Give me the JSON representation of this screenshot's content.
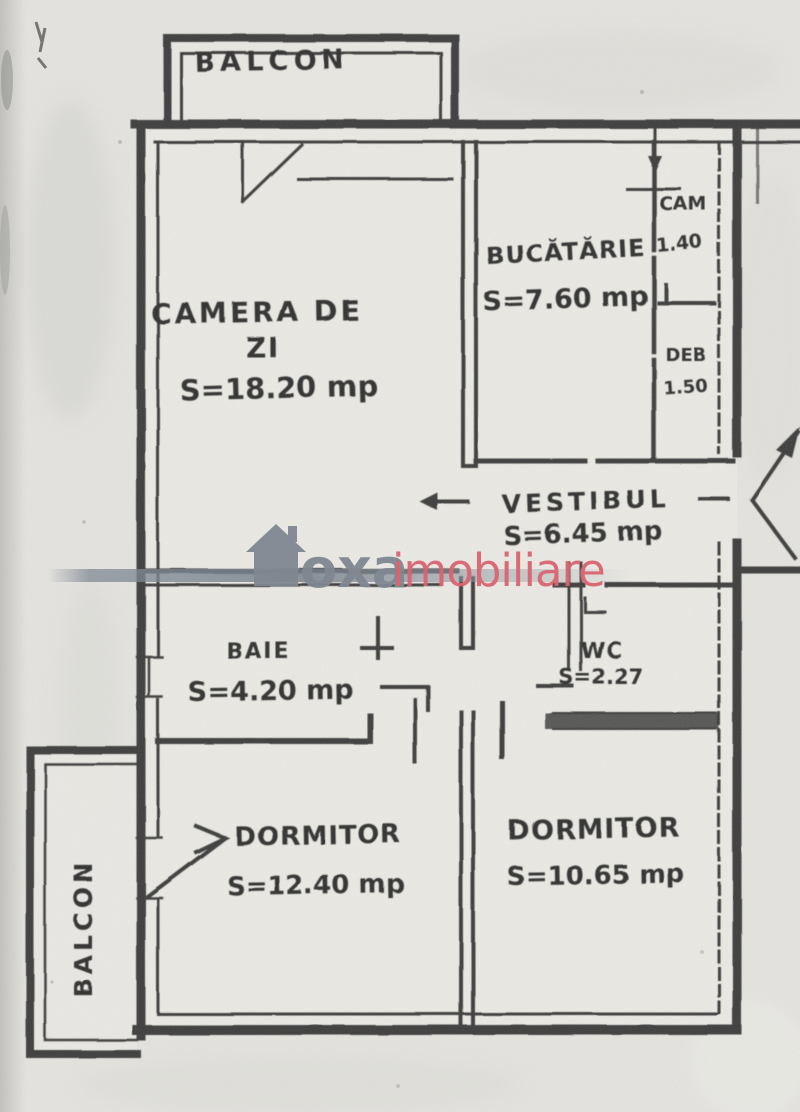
{
  "document": {
    "type": "scanned apartment floor plan",
    "language": "Romanian"
  },
  "plan": {
    "balconies": [
      {
        "label": "BALCON",
        "position": "top"
      },
      {
        "label": "BALCON",
        "position": "left"
      }
    ],
    "rooms": [
      {
        "name": "CAMERA DE",
        "name_line2": "ZI",
        "area": "S=18.20 mp"
      },
      {
        "name": "BUCĂTĂRIE",
        "area": "S=7.60 mp"
      },
      {
        "name": "CAM",
        "area": "1.40"
      },
      {
        "name": "DEB",
        "area": "1.50"
      },
      {
        "name": "VESTIBUL",
        "area": "S=6.45 mp"
      },
      {
        "name": "BAIE",
        "area": "S=4.20 mp"
      },
      {
        "name": "WC",
        "area": "S=2.27"
      },
      {
        "name": "DORMITOR",
        "area": "S=12.40 mp"
      },
      {
        "name": "DORMITOR",
        "area": "S=10.65 mp"
      }
    ]
  },
  "watermark": {
    "icon": "house-icon",
    "brand_primary": "oxa",
    "brand_secondary": "imobiliare",
    "primary_color": "#7f8791",
    "secondary_color": "#d96470"
  },
  "colors": {
    "paper": "#e7e6e2",
    "ink": "#343434",
    "room_fill": "#edece8"
  }
}
